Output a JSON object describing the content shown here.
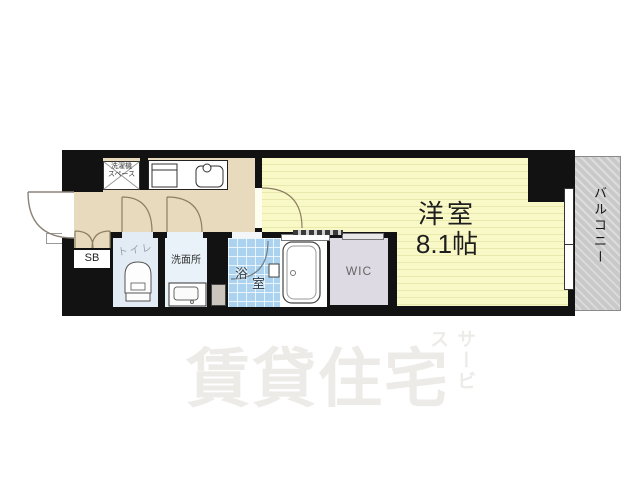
{
  "plan": {
    "rooms": {
      "living": {
        "name": "洋室",
        "size": "8.1帖"
      },
      "balcony": {
        "name": "バルコニー"
      },
      "wic": {
        "name": "WIC"
      },
      "bath": {
        "char1": "浴",
        "char2": "室"
      },
      "washroom": {
        "name": "洗面所"
      },
      "toilet": {
        "name": "トイレ"
      },
      "shoebox": {
        "name": "SB"
      },
      "laundry": {
        "line1": "洗濯機",
        "line2": "スペース"
      }
    },
    "colors": {
      "wall": "#121212",
      "hall_floor": "#e7dabd",
      "living_floor": "#f9f9c8",
      "bath_tile": "#abd2ee",
      "toilet_floor": "#e3ecf4",
      "washroom_floor": "#e9f1f9",
      "wic_floor": "#dddae3",
      "balcony": "#c9c9c9"
    }
  },
  "watermark": {
    "main": "賃貸住宅",
    "sub": "サービス"
  }
}
